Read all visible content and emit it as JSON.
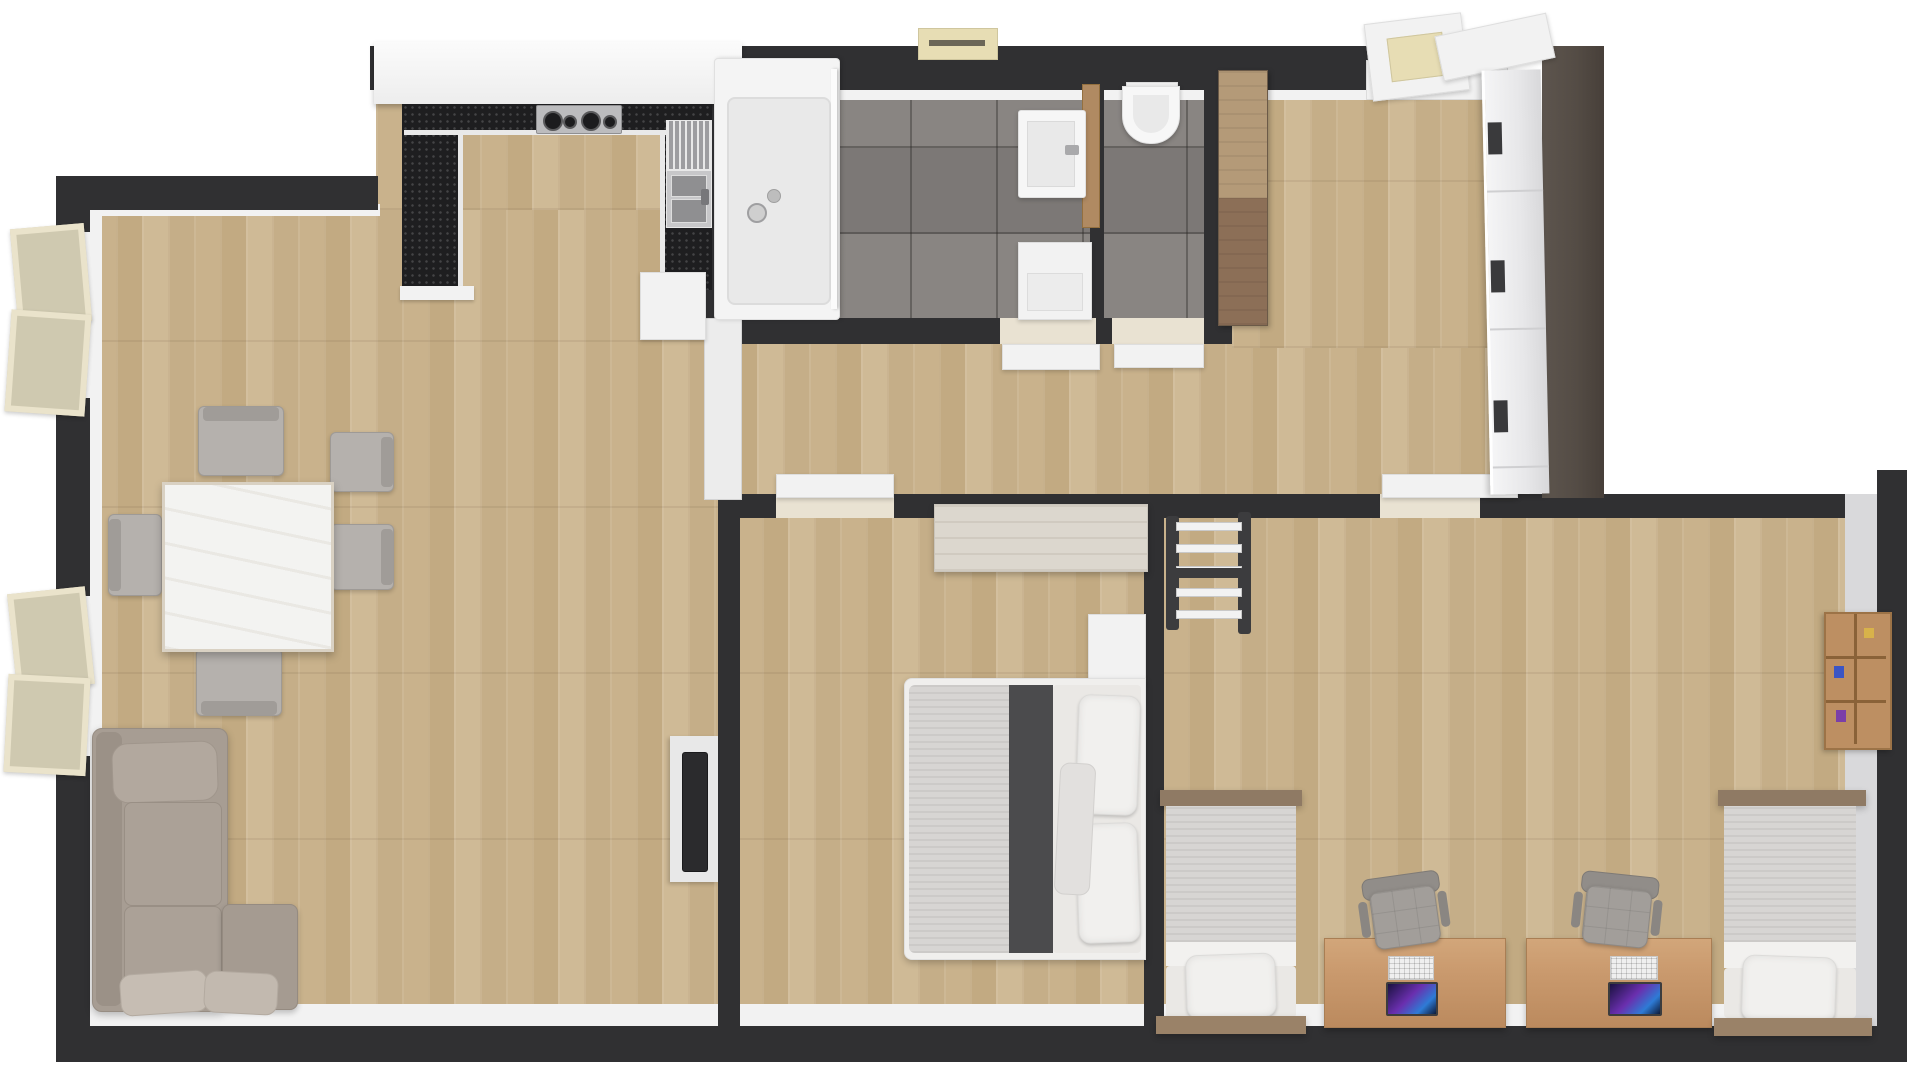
{
  "meta": {
    "title": "3D rendered apartment floor plan, top-down view",
    "render_type": "floor-plan"
  },
  "palette": {
    "wall": "#303032",
    "panel": "#544c45",
    "whitef": "#f2f2f2",
    "wood1": "#c9b28c",
    "wood2": "#c2aa82",
    "wood3": "#cfba96",
    "wood4": "#c5ae88",
    "tile": "#84807d",
    "tileline": "rgba(42,40,38,.38)",
    "counter": "#1e1e20",
    "sofa": "#a79d93",
    "sofacushion": "#aba197",
    "chairgray": "#b5b1ad",
    "mattress": "#d7d5d3",
    "duvet": "#eae8e5",
    "runner": "#4b4b4d",
    "deskwood": "#c9996d",
    "bedwood": "#8f7a64",
    "headwood": "#9a8268",
    "shelfwood": "#bd8f62",
    "cabtop": "#b49a78",
    "cabbot": "#8c6f57",
    "winframe": "#eae3cb",
    "pane": "#cfc9b0",
    "beige": "#e7ddb4",
    "officechair": "#a29e9a",
    "screen1": "#6a2fae",
    "screen2": "#2e7bd6"
  },
  "rooms": [
    {
      "name": "living-room",
      "floor": "wood",
      "furniture": [
        "corner-sofa",
        "sofa-pillows",
        "dining-table",
        "dining-chairs-x5",
        "tv-on-wall",
        "open-window-1",
        "open-window-2"
      ]
    },
    {
      "name": "kitchen",
      "floor": "wood",
      "furniture": [
        "u-shaped-black-counter",
        "cooktop-4-burners",
        "double-sink-with-drainer",
        "white-upper-cabinet-row",
        "white-base-cabinet"
      ]
    },
    {
      "name": "bathroom",
      "floor": "gray-tile",
      "furniture": [
        "shower-enclosure",
        "wash-basin-on-wood-panel",
        "washing-machine",
        "open-door"
      ]
    },
    {
      "name": "wc",
      "floor": "gray-tile",
      "furniture": [
        "toilet",
        "open-door"
      ]
    },
    {
      "name": "hallway",
      "floor": "wood",
      "furniture": [
        "tall-wood-cabinet",
        "white-wardrobe-with-dark-handles",
        "dark-brown-side-panel",
        "entrance-threshold",
        "ceiling-lamp",
        "ceiling-vent"
      ]
    },
    {
      "name": "bedroom",
      "floor": "wood",
      "furniture": [
        "double-bed-with-dark-runner",
        "pillows-x2",
        "dresser",
        "nightstand",
        "open-door"
      ]
    },
    {
      "name": "kids-room",
      "floor": "wood",
      "furniture": [
        "single-bed-1",
        "single-bed-2",
        "desk-1-with-laptop",
        "desk-2-with-laptop",
        "office-chair-1",
        "office-chair-2",
        "wall-bars",
        "wall-shelf",
        "open-door"
      ]
    }
  ],
  "counts": {
    "beds": 3,
    "desks": 2,
    "office_chairs": 2,
    "dining_chairs": 5,
    "windows": 2,
    "doors_open": 5
  }
}
